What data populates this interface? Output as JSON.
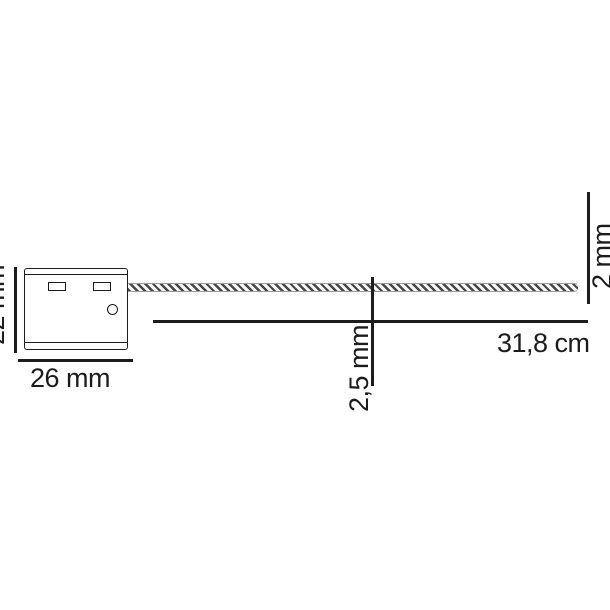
{
  "diagram": {
    "kind": "technical dimension drawing",
    "subject": "security cable seal with long cable",
    "colors": {
      "background": "#ffffff",
      "line": "#1c1c1c",
      "cable_stripe": "#474747",
      "cable_edge": "#9a9a9a"
    },
    "seal_body": {
      "width_label": "26 mm",
      "height_label": "22 mm"
    },
    "cable": {
      "length_label": "31,8 cm",
      "diameter_label": "2,5 mm",
      "tip_label": "2 mm"
    }
  }
}
